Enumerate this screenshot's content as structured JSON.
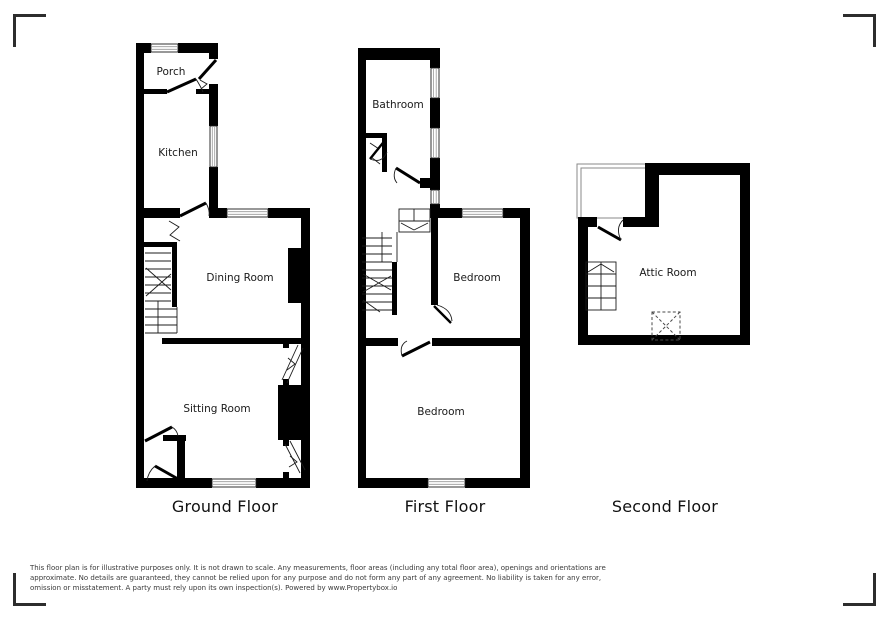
{
  "colors": {
    "wall": "#000000",
    "line": "#1c1c1c",
    "window-line": "#999999",
    "text": "#1a1a1a",
    "floor-label": "#111111",
    "disclaimer": "#3a3a3a",
    "bracket": "#2d2d2d",
    "background": "#ffffff"
  },
  "floors": {
    "ground": {
      "label": "Ground Floor",
      "rooms": {
        "porch": "Porch",
        "kitchen": "Kitchen",
        "dining": "Dining Room",
        "sitting": "Sitting Room"
      }
    },
    "first": {
      "label": "First Floor",
      "rooms": {
        "bathroom": "Bathroom",
        "bedroom_rear": "Bedroom",
        "bedroom_front": "Bedroom"
      }
    },
    "second": {
      "label": "Second Floor",
      "rooms": {
        "attic": "Attic Room"
      }
    }
  },
  "disclaimer": {
    "lines": [
      "This floor plan is for illustrative purposes only. It is not drawn to scale. Any measurements, floor areas (including any total floor area), openings and orientations are",
      "approximate. No details are guaranteed, they cannot be relied upon for any purpose and do not form any part of any agreement. No liability is taken for any error,",
      "omission or misstatement. A party must rely upon its own inspection(s). Powered by www.Propertybox.io"
    ]
  }
}
